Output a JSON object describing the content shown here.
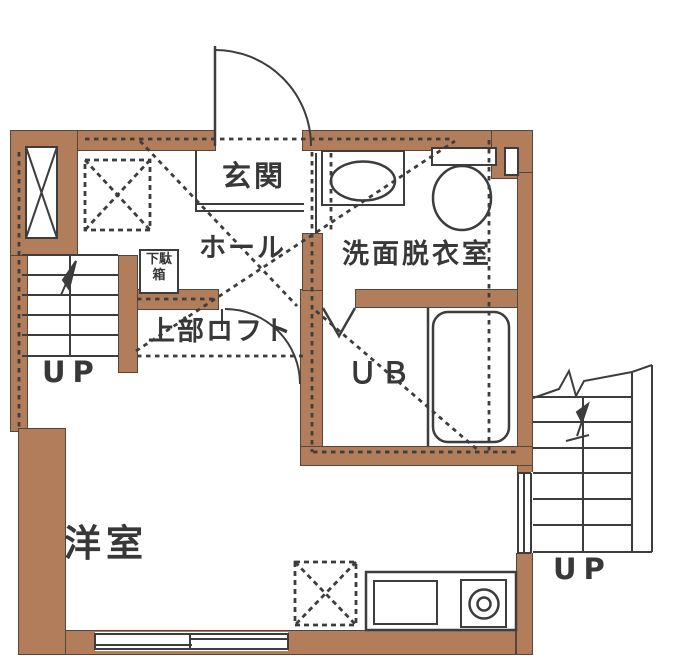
{
  "plan": {
    "type": "floor-plan",
    "rooms": {
      "genkan": "玄関",
      "hall": "ホール",
      "washroom": "洗面脱衣室",
      "loft": "上部ロフト",
      "unit_bath": "ＵＢ",
      "western_room": "洋室",
      "shoe_cabinet": "下駄箱"
    },
    "stairs": {
      "left_label": "UP",
      "right_label": "UP"
    },
    "colors": {
      "wall": "#b17d5a",
      "wall_outline": "#55463a",
      "line": "#3d3d3d",
      "background": "#ffffff"
    }
  }
}
